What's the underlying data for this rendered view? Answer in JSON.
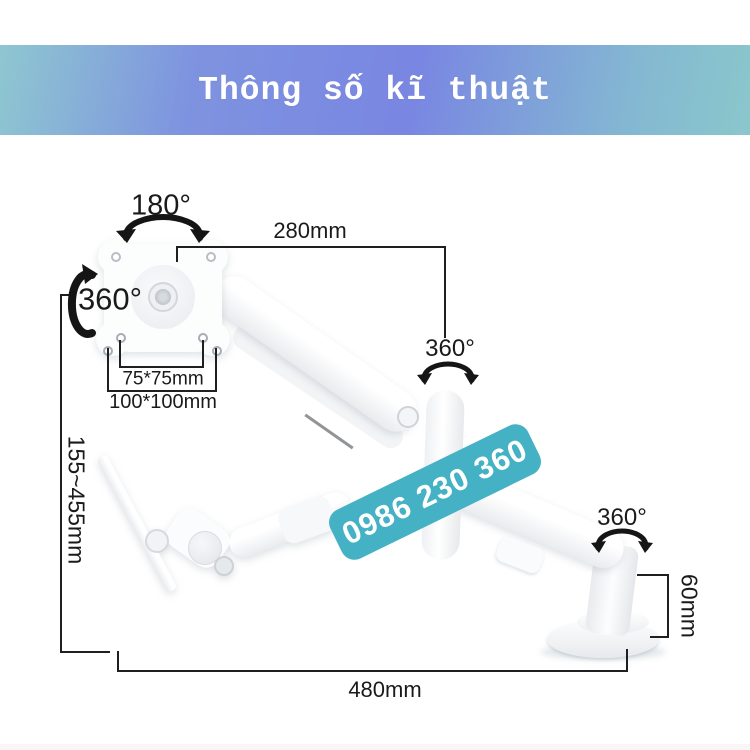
{
  "header": {
    "title": "Thông số kĩ thuật"
  },
  "watermark": {
    "phone": "0986 230 360"
  },
  "dimensions": {
    "top_rotation": "180°",
    "upper_arm_length": "280mm",
    "elbow_rotation": "360°",
    "vesa_rotation": "360°",
    "base_rotation": "360°",
    "vesa_pattern_small": "75*75mm",
    "vesa_pattern_large": "100*100mm",
    "height_range": "155~455mm",
    "base_column_height": "60mm",
    "horizontal_reach": "480mm"
  },
  "colors": {
    "header_text": "#ffffff",
    "banner_teal": "#8ec7d0",
    "banner_blue": "#7986e2",
    "watermark_bg": "#44b1c4",
    "watermark_text": "#ffffff",
    "line_color": "#1f1f1f",
    "label_color": "#1a1a1a",
    "product_white": "#ffffff"
  }
}
